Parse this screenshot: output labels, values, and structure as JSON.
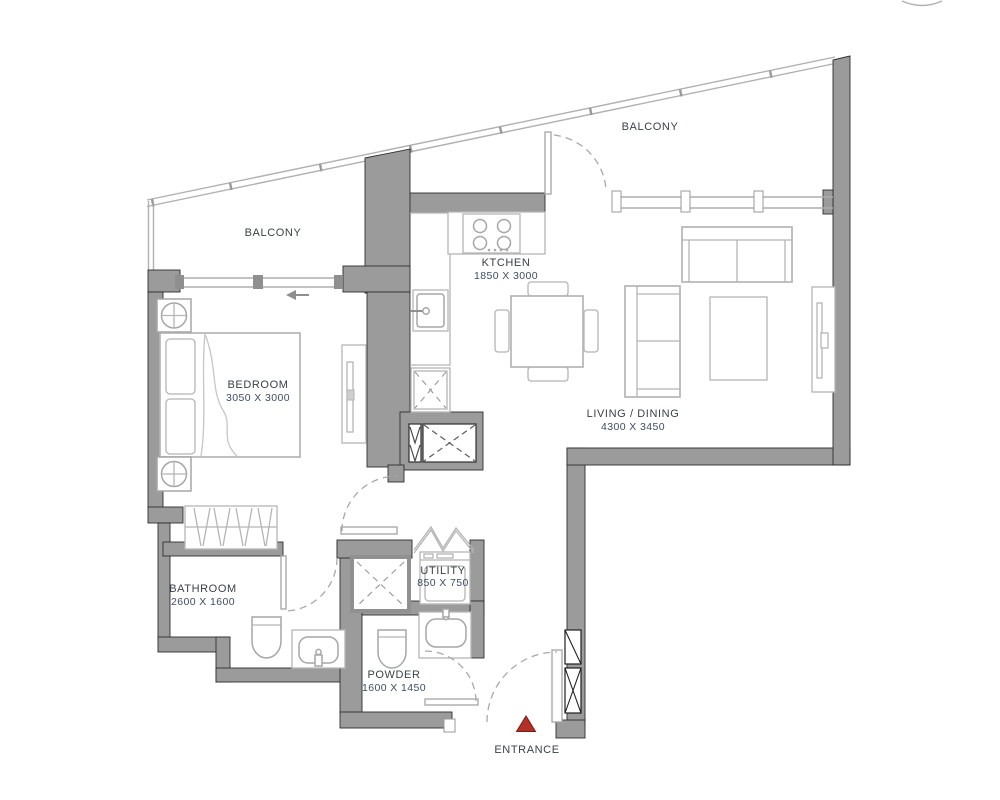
{
  "title": "Apartment Floor Plan",
  "colors": {
    "wall": "#9b9b9b",
    "wall_outline": "#2e2e2e",
    "furniture_line": "#b5b5b5",
    "fixture_line": "#a6a6a6",
    "room_text": "#3a3f47",
    "dim_text": "#3e4d63",
    "entrance_marker": "#b23127"
  },
  "rooms": {
    "balcony_top": {
      "label": "BALCONY"
    },
    "balcony_left": {
      "label": "BALCONY"
    },
    "kitchen": {
      "label": "KTCHEN",
      "dims": "1850 X 3000"
    },
    "bedroom": {
      "label": "BEDROOM",
      "dims": "3050 X 3000"
    },
    "living_dining": {
      "label": "LIVING / DINING",
      "dims": "4300 X 3450"
    },
    "bathroom": {
      "label": "BATHROOM",
      "dims": "2600 X 1600"
    },
    "utility": {
      "label": "UTILITY",
      "dims": "850 X 750"
    },
    "powder": {
      "label": "POWDER",
      "dims": "1600 X 1450"
    }
  },
  "entrance": {
    "label": "ENTRANCE"
  }
}
